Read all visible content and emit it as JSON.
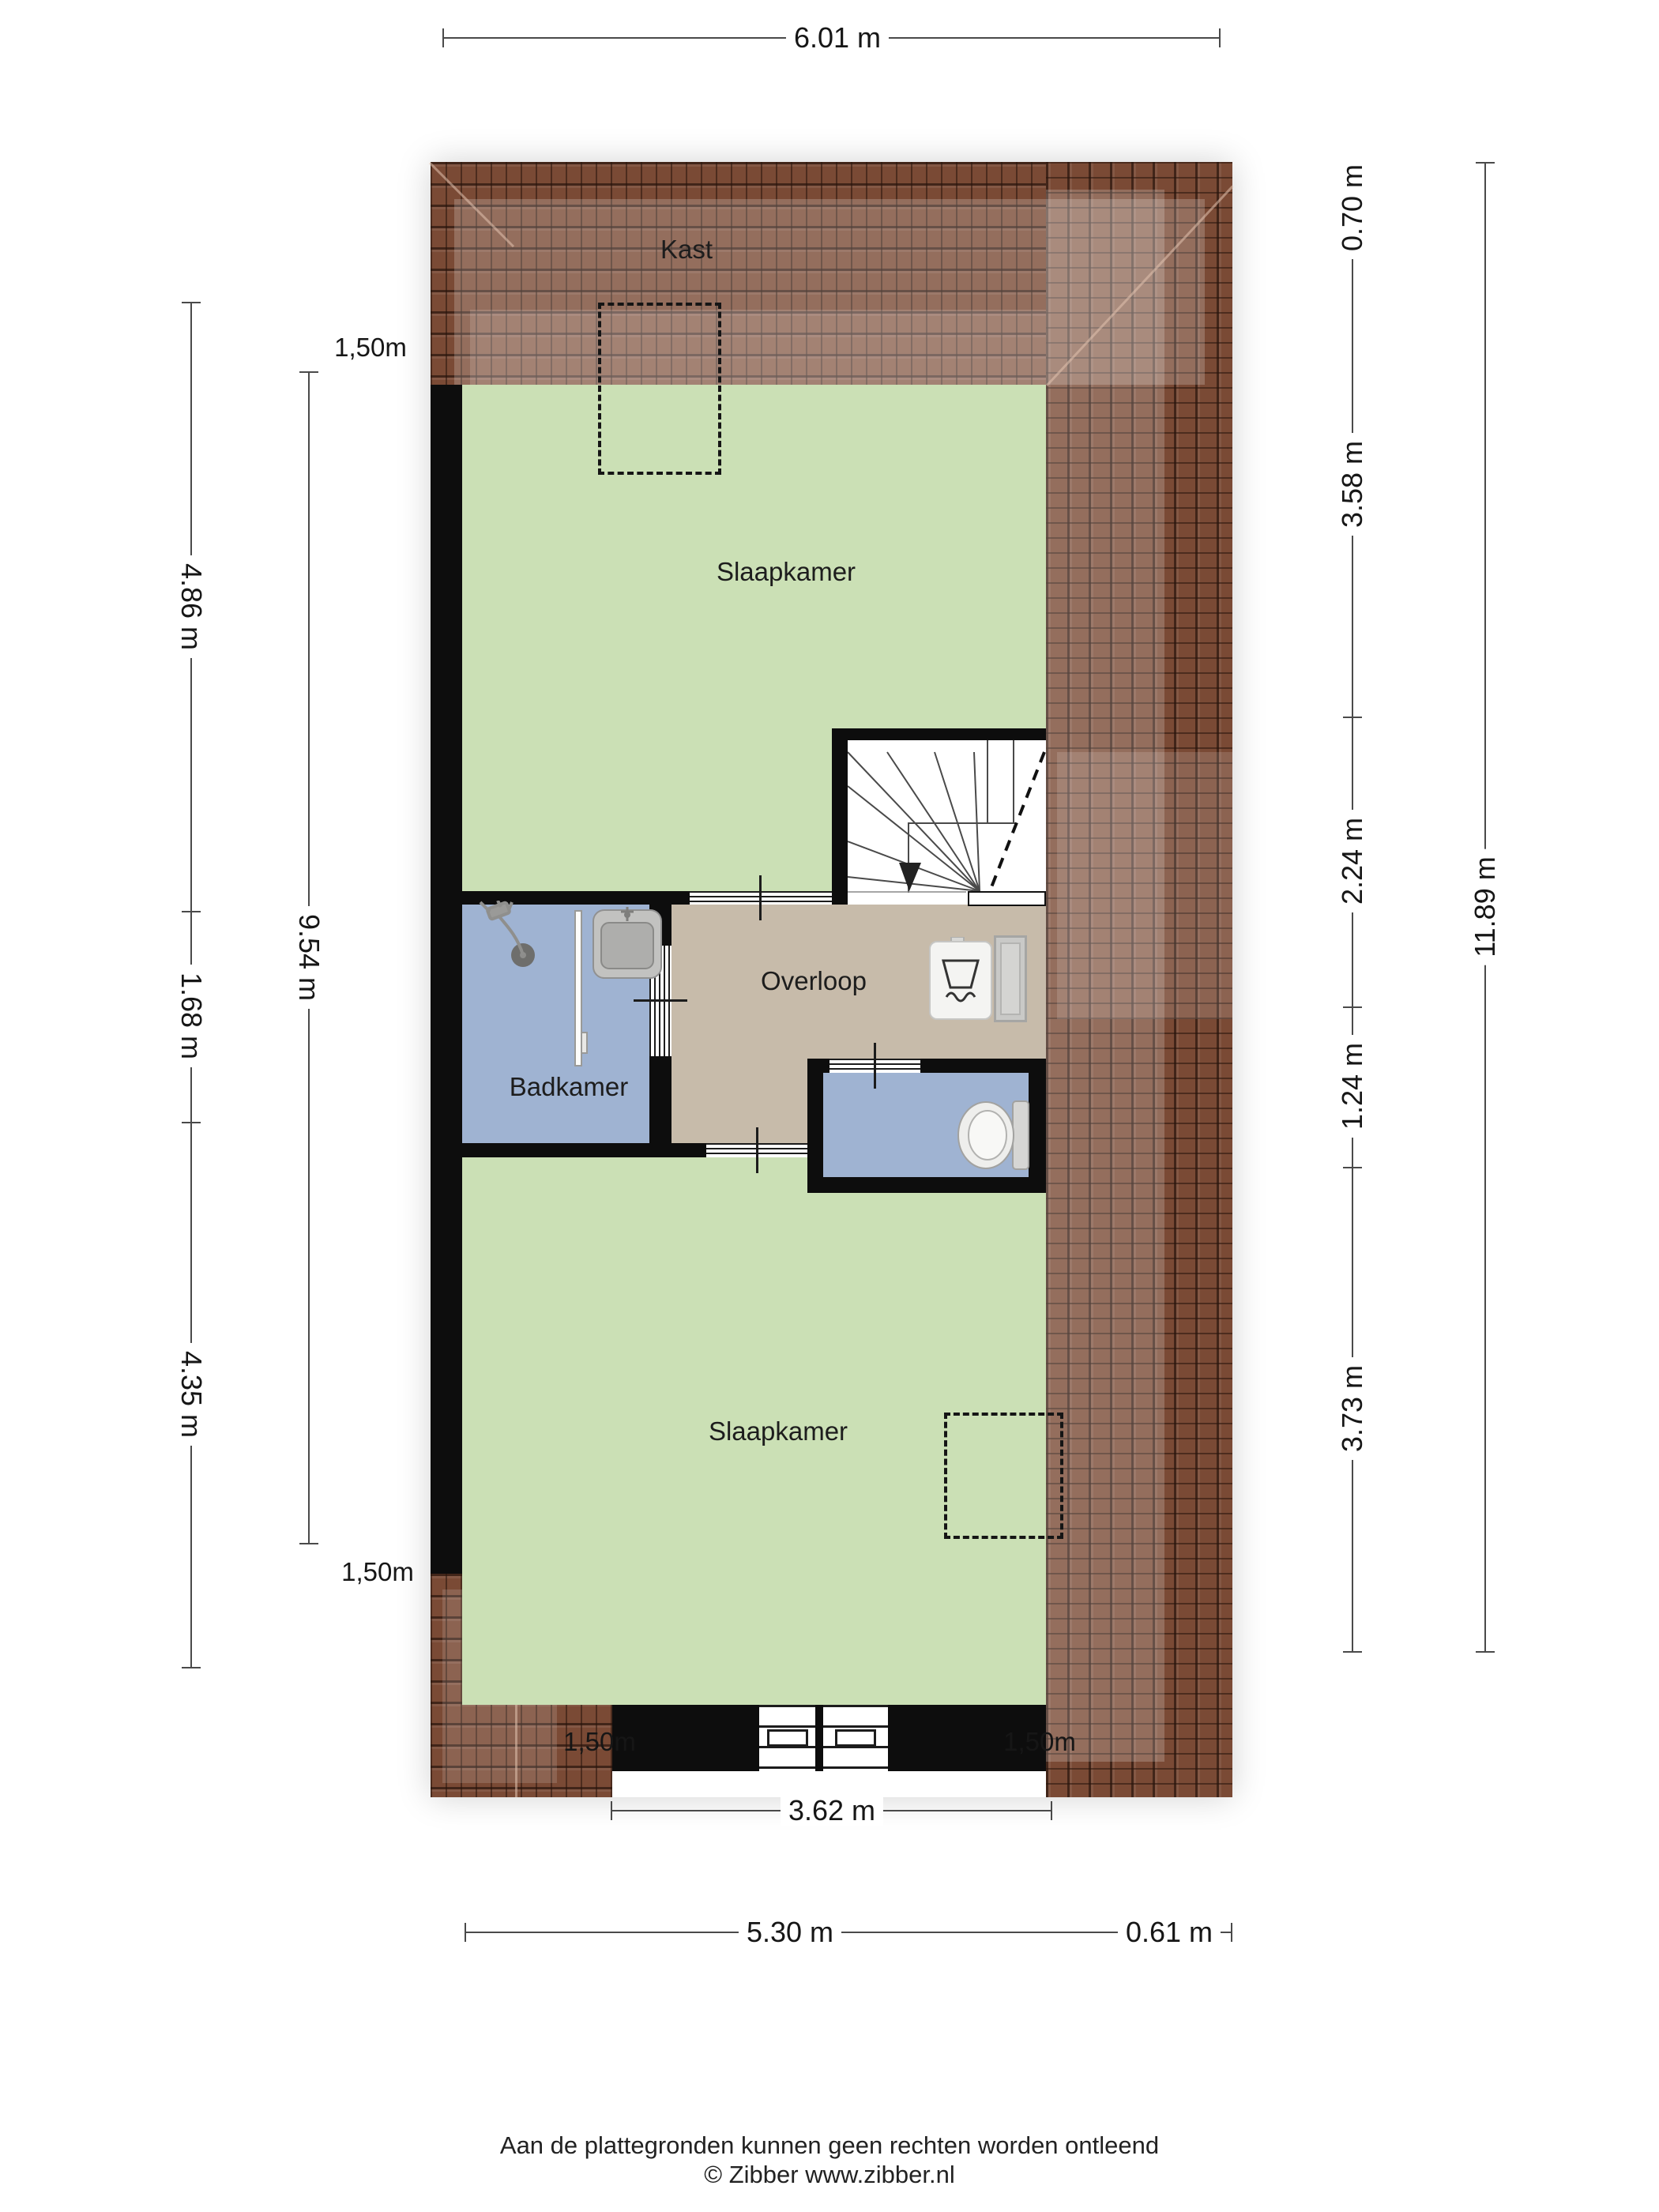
{
  "rooms": {
    "kast": "Kast",
    "bedroom_top": "Slaapkamer",
    "landing": "Overloop",
    "bathroom": "Badkamer",
    "bedroom_bottom": "Slaapkamer"
  },
  "dimensions": {
    "top_width": "6.01 m",
    "right": [
      "0.70 m",
      "3.58 m",
      "2.24 m",
      "1.24 m",
      "3.73 m"
    ],
    "right_total": "11.89 m",
    "left": [
      "4.86 m",
      "1.68 m",
      "4.35 m"
    ],
    "left_inner_total": "9.54 m",
    "headroom_left_top": "1,50m",
    "headroom_left_bottom": "1,50m",
    "headroom_bottom_left": "1,50m",
    "headroom_bottom_right": "1,50m",
    "bottom_inner_width": "3.62 m",
    "bottom_width": "5.30 m",
    "bottom_overhang": "0.61 m"
  },
  "footer": {
    "disclaimer": "Aan de plattegronden kunnen geen rechten worden ontleend",
    "credit": "© Zibber www.zibber.nl"
  },
  "colors": {
    "floor_green": "#cbe0b5",
    "floor_blue": "#9fb3d2",
    "floor_beige": "#c7bbaa",
    "roof_brown": "#7a4a35",
    "wall_black": "#0d0d0d"
  }
}
